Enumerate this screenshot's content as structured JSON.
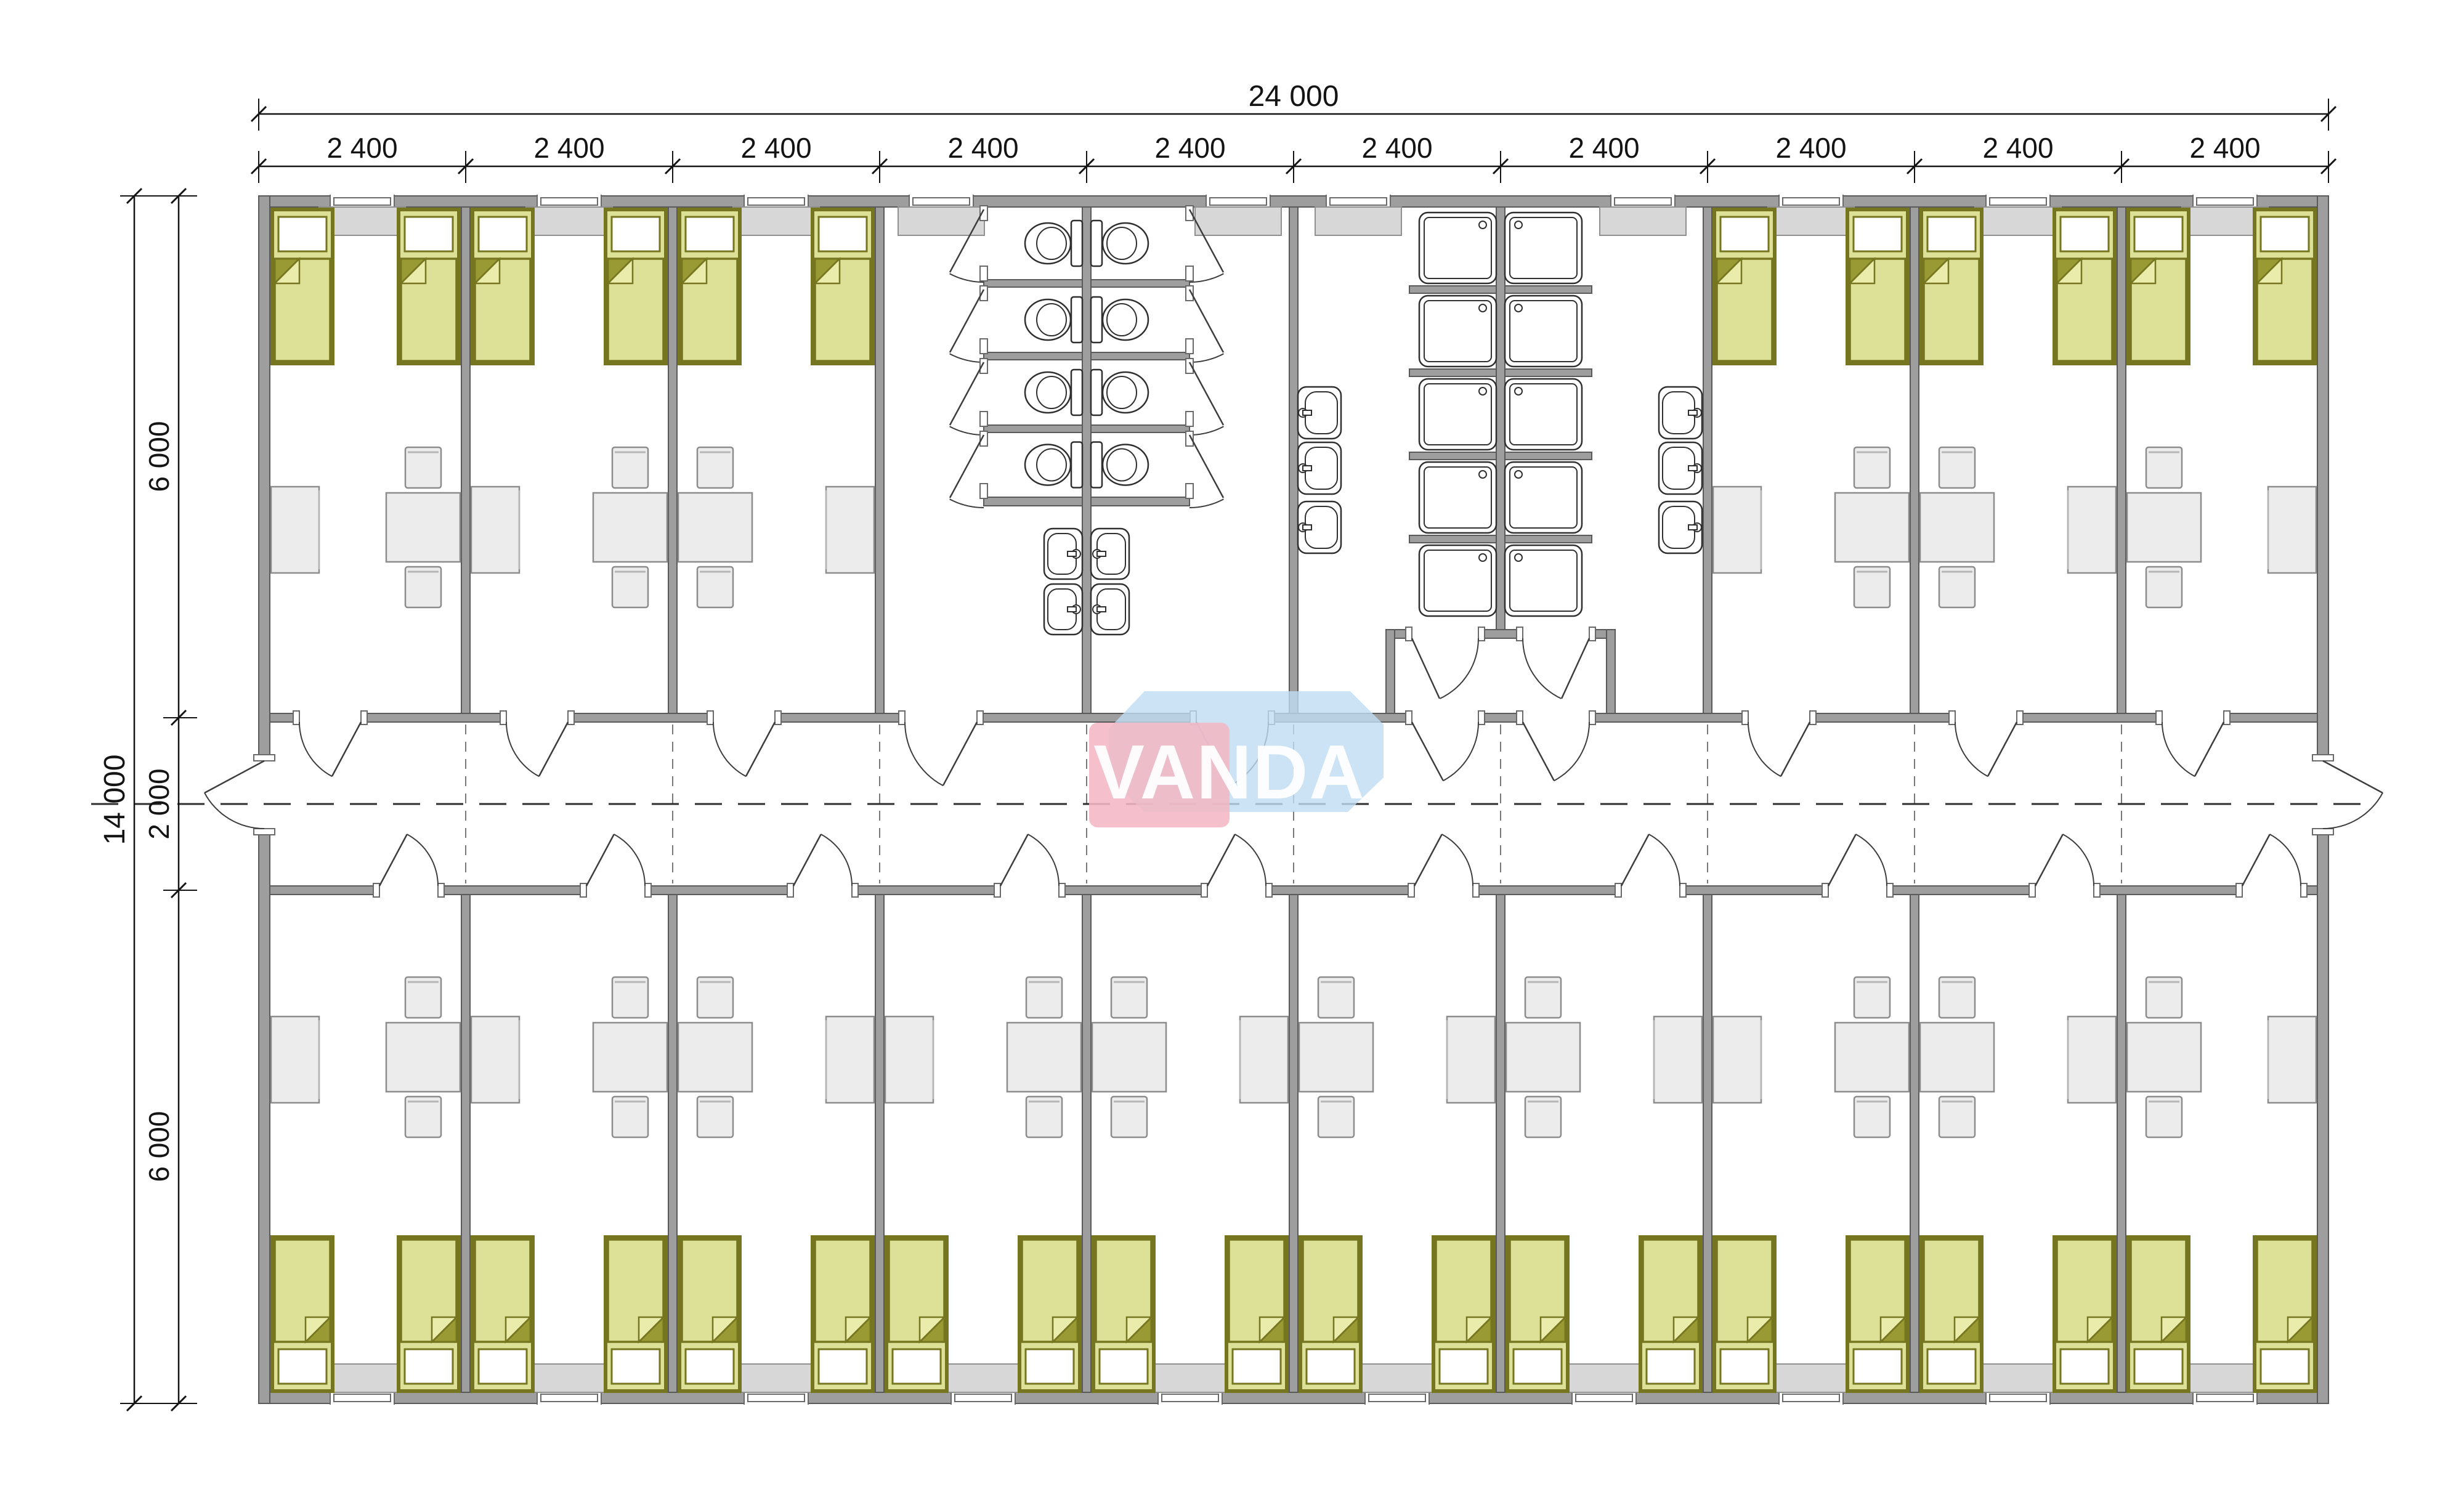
{
  "watermark": {
    "text": "VANDA"
  },
  "dimensions": {
    "top_total": "24 000",
    "top_segments": [
      "2 400",
      "2 400",
      "2 400",
      "2 400",
      "2 400",
      "2 400",
      "2 400",
      "2 400",
      "2 400",
      "2 400"
    ],
    "left_total": "14 000",
    "left_segments": [
      "6 000",
      "2 000",
      "6 000"
    ]
  },
  "colors": {
    "wall": "#9e9e9e",
    "wall_stroke": "#5a5a5a",
    "line": "#3d3d3d",
    "dim": "#141414",
    "bed_fill": "#dde198",
    "bed_stroke": "#75761f",
    "bed_fold": "#999a33",
    "bed_fold_light": "#eaecab",
    "furniture_fill": "#ececec",
    "furniture_stroke": "#8c8c8c",
    "sill_fill": "#d7d7d7",
    "sill_stroke": "#909090",
    "fixture_stroke": "#2f2f2f",
    "logo_pink": "#f3b7c3",
    "logo_blue": "#bedcf2",
    "logo_text": "#ffffff"
  },
  "plan": {
    "modules": 10,
    "module_width_mm": 2400,
    "building_width_mm": 24000,
    "building_depth_mm": 14000,
    "corridor_depth_mm": 2000,
    "room_band_depth_mm": 6000,
    "top_rooms": [
      {
        "id": "bedroom-top-1",
        "module": 1,
        "kind": "bedroom",
        "beds": 2,
        "left": "desk",
        "right": "table"
      },
      {
        "id": "bedroom-top-2",
        "module": 2,
        "kind": "bedroom",
        "beds": 2,
        "left": "desk",
        "right": "table"
      },
      {
        "id": "bedroom-top-3",
        "module": 3,
        "kind": "bedroom",
        "beds": 2,
        "left": "table",
        "right": "desk"
      },
      {
        "id": "wc-room-left",
        "module": 4,
        "kind": "wc",
        "toilet_stalls": 4,
        "wash_basins": 2
      },
      {
        "id": "wc-room-right",
        "module": 5,
        "kind": "wc",
        "toilet_stalls": 4,
        "wash_basins": 2
      },
      {
        "id": "shower-room-left",
        "module": 6,
        "kind": "shower",
        "shower_trays": 5,
        "sinks": 3
      },
      {
        "id": "shower-room-right",
        "module": 7,
        "kind": "shower",
        "shower_trays": 5,
        "sinks": 3
      },
      {
        "id": "bedroom-top-8",
        "module": 8,
        "kind": "bedroom",
        "beds": 2,
        "left": "desk",
        "right": "table"
      },
      {
        "id": "bedroom-top-9",
        "module": 9,
        "kind": "bedroom",
        "beds": 2,
        "left": "table",
        "right": "desk"
      },
      {
        "id": "bedroom-top-10",
        "module": 10,
        "kind": "bedroom",
        "beds": 2,
        "left": "table",
        "right": "desk"
      }
    ],
    "bottom_rooms": [
      {
        "id": "bedroom-bottom-1",
        "module": 1,
        "kind": "bedroom",
        "beds": 2,
        "left": "desk",
        "right": "table"
      },
      {
        "id": "bedroom-bottom-2",
        "module": 2,
        "kind": "bedroom",
        "beds": 2,
        "left": "desk",
        "right": "table"
      },
      {
        "id": "bedroom-bottom-3",
        "module": 3,
        "kind": "bedroom",
        "beds": 2,
        "left": "table",
        "right": "desk"
      },
      {
        "id": "bedroom-bottom-4",
        "module": 4,
        "kind": "bedroom",
        "beds": 2,
        "left": "desk",
        "right": "table"
      },
      {
        "id": "bedroom-bottom-5",
        "module": 5,
        "kind": "bedroom",
        "beds": 2,
        "left": "table",
        "right": "desk"
      },
      {
        "id": "bedroom-bottom-6",
        "module": 6,
        "kind": "bedroom",
        "beds": 2,
        "left": "table",
        "right": "desk"
      },
      {
        "id": "bedroom-bottom-7",
        "module": 7,
        "kind": "bedroom",
        "beds": 2,
        "left": "table",
        "right": "desk"
      },
      {
        "id": "bedroom-bottom-8",
        "module": 8,
        "kind": "bedroom",
        "beds": 2,
        "left": "desk",
        "right": "table"
      },
      {
        "id": "bedroom-bottom-9",
        "module": 9,
        "kind": "bedroom",
        "beds": 2,
        "left": "table",
        "right": "desk"
      },
      {
        "id": "bedroom-bottom-10",
        "module": 10,
        "kind": "bedroom",
        "beds": 2,
        "left": "table",
        "right": "desk"
      }
    ],
    "corridor": {
      "doors_to_top_rooms": 10,
      "doors_to_bottom_rooms": 10,
      "exterior_end_doors": 2
    }
  }
}
